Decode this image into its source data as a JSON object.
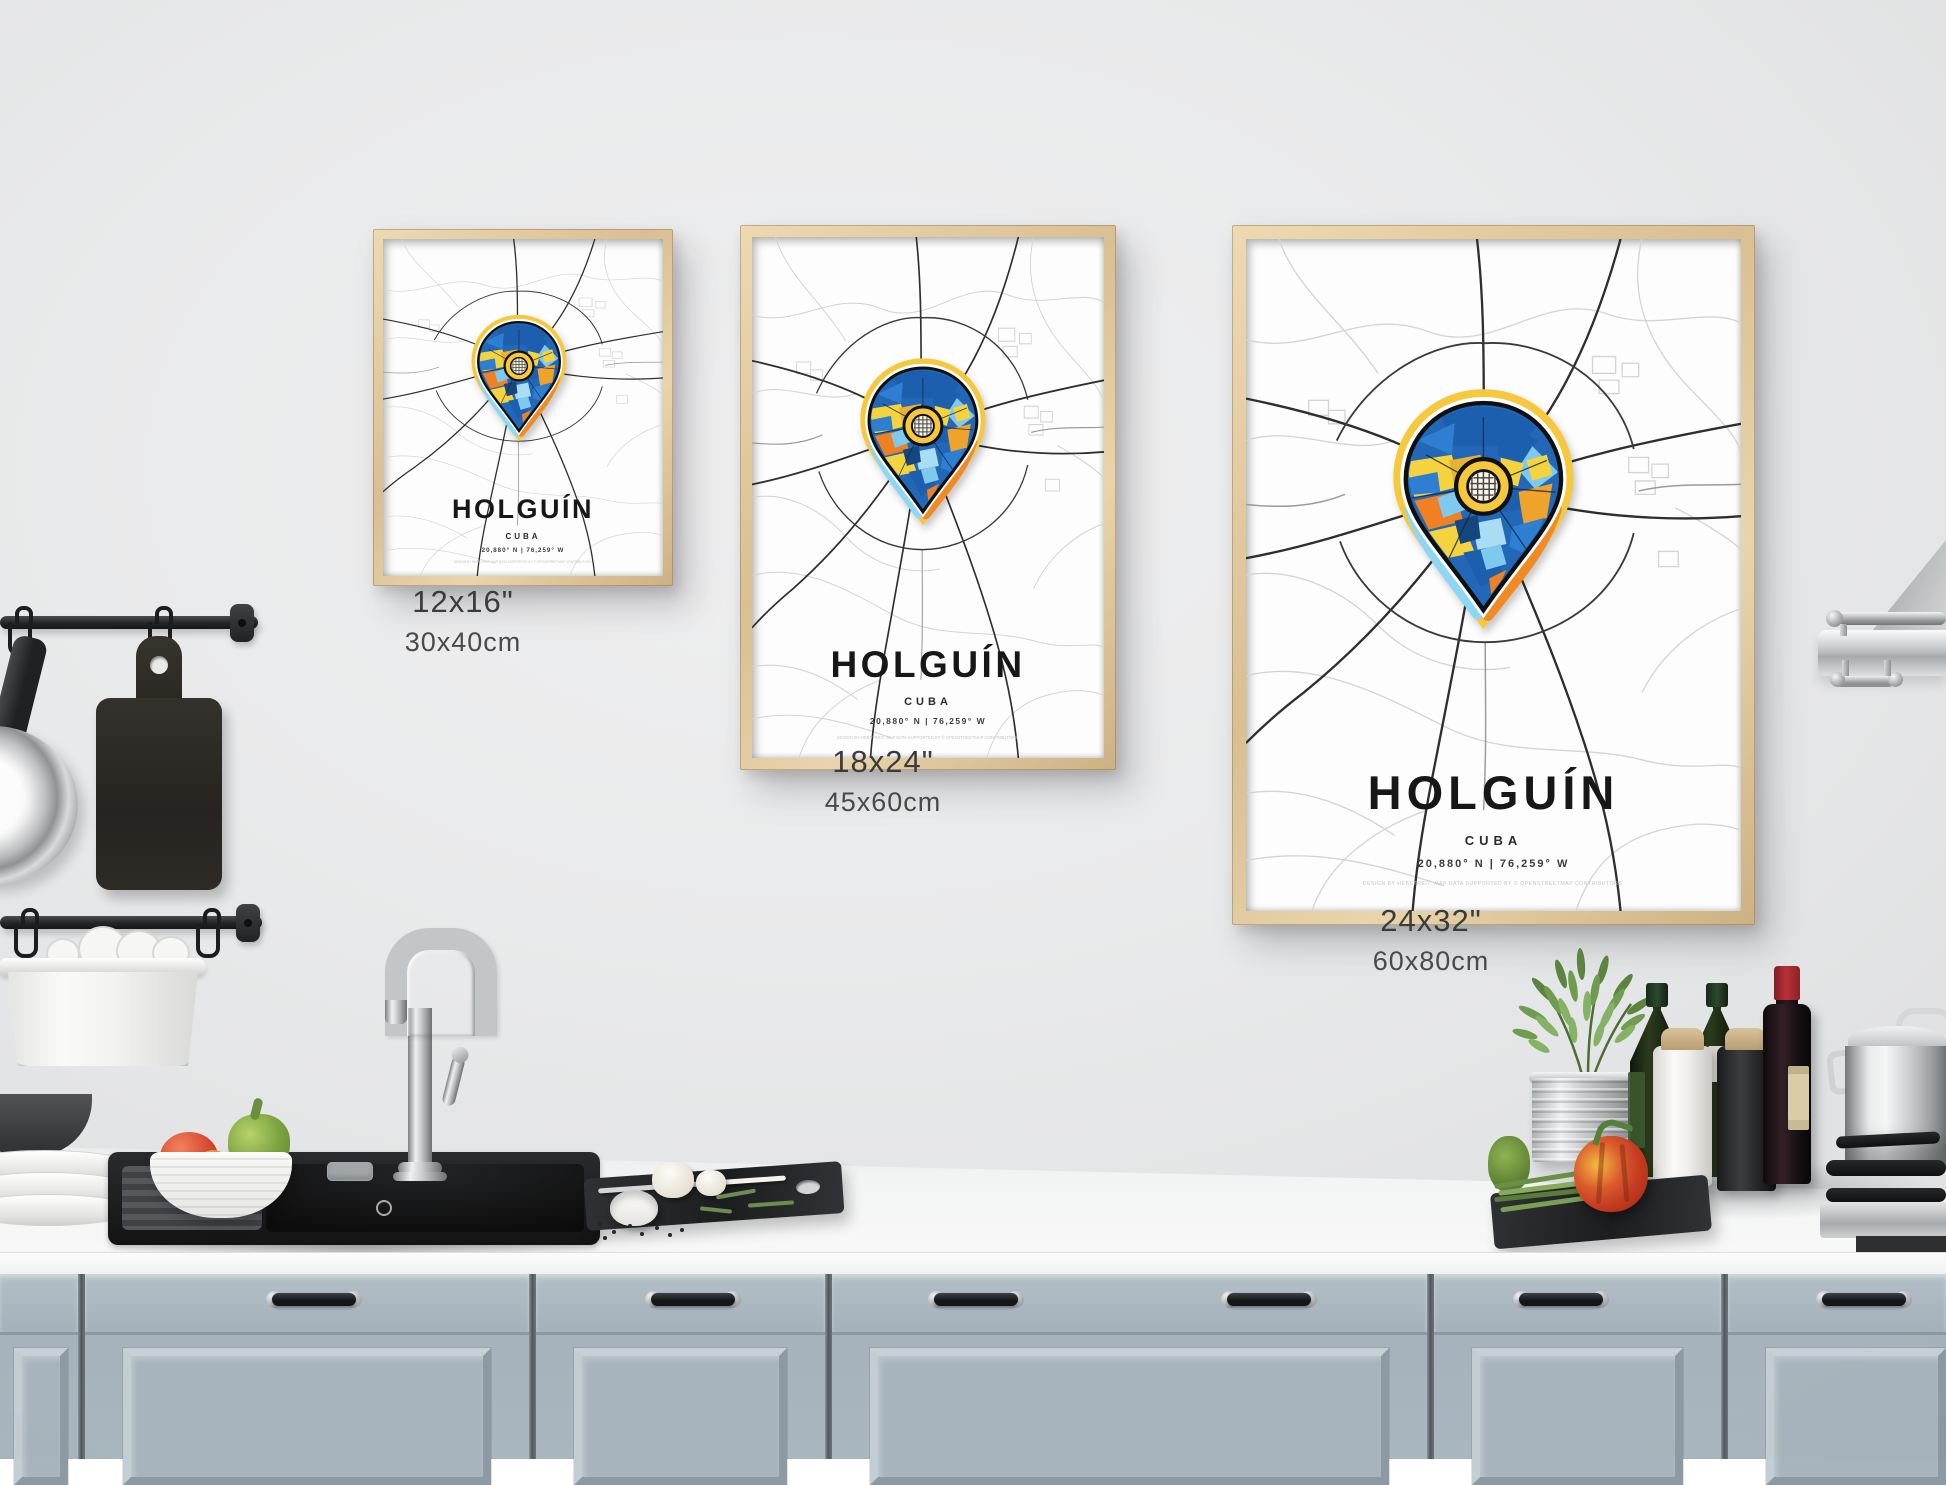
{
  "scene": {
    "wall_color": "#e9eaeb",
    "counter_color": "#f4f5f5",
    "cabinet_color": "#a9b6bf",
    "frame_wood_color": "#dfc69b"
  },
  "posters": [
    {
      "title": "HOLGUÍN",
      "country": "CUBA",
      "coordinates": "20,880° N | 76,259° W",
      "credit": "DESIGN BY HEBSTREIT. MAP DATA SUPPORTED BY © OPENSTREETMAP CONTRIBUTORS.",
      "size_label_in": "12x16\"",
      "size_label_cm": "30x40cm"
    },
    {
      "title": "HOLGUÍN",
      "country": "CUBA",
      "coordinates": "20,880° N | 76,259° W",
      "credit": "DESIGN BY HEBSTREIT. MAP DATA SUPPORTED BY © OPENSTREETMAP CONTRIBUTORS.",
      "size_label_in": "18x24\"",
      "size_label_cm": "45x60cm"
    },
    {
      "title": "HOLGUÍN",
      "country": "CUBA",
      "coordinates": "20,880° N | 76,259° W",
      "credit": "DESIGN BY HEBSTREIT. MAP DATA SUPPORTED BY © OPENSTREETMAP CONTRIBUTORS.",
      "size_label_in": "24x32\"",
      "size_label_cm": "60x80cm"
    }
  ],
  "map": {
    "major_road_color": "#2e2e2e",
    "minor_road_color": "#d2d2d2",
    "pin_palette": [
      "#1c5fae",
      "#2e7fd2",
      "#7fc9ee",
      "#f5d33f",
      "#ef8122",
      "#f6c83d",
      "#8ed7f3"
    ]
  }
}
